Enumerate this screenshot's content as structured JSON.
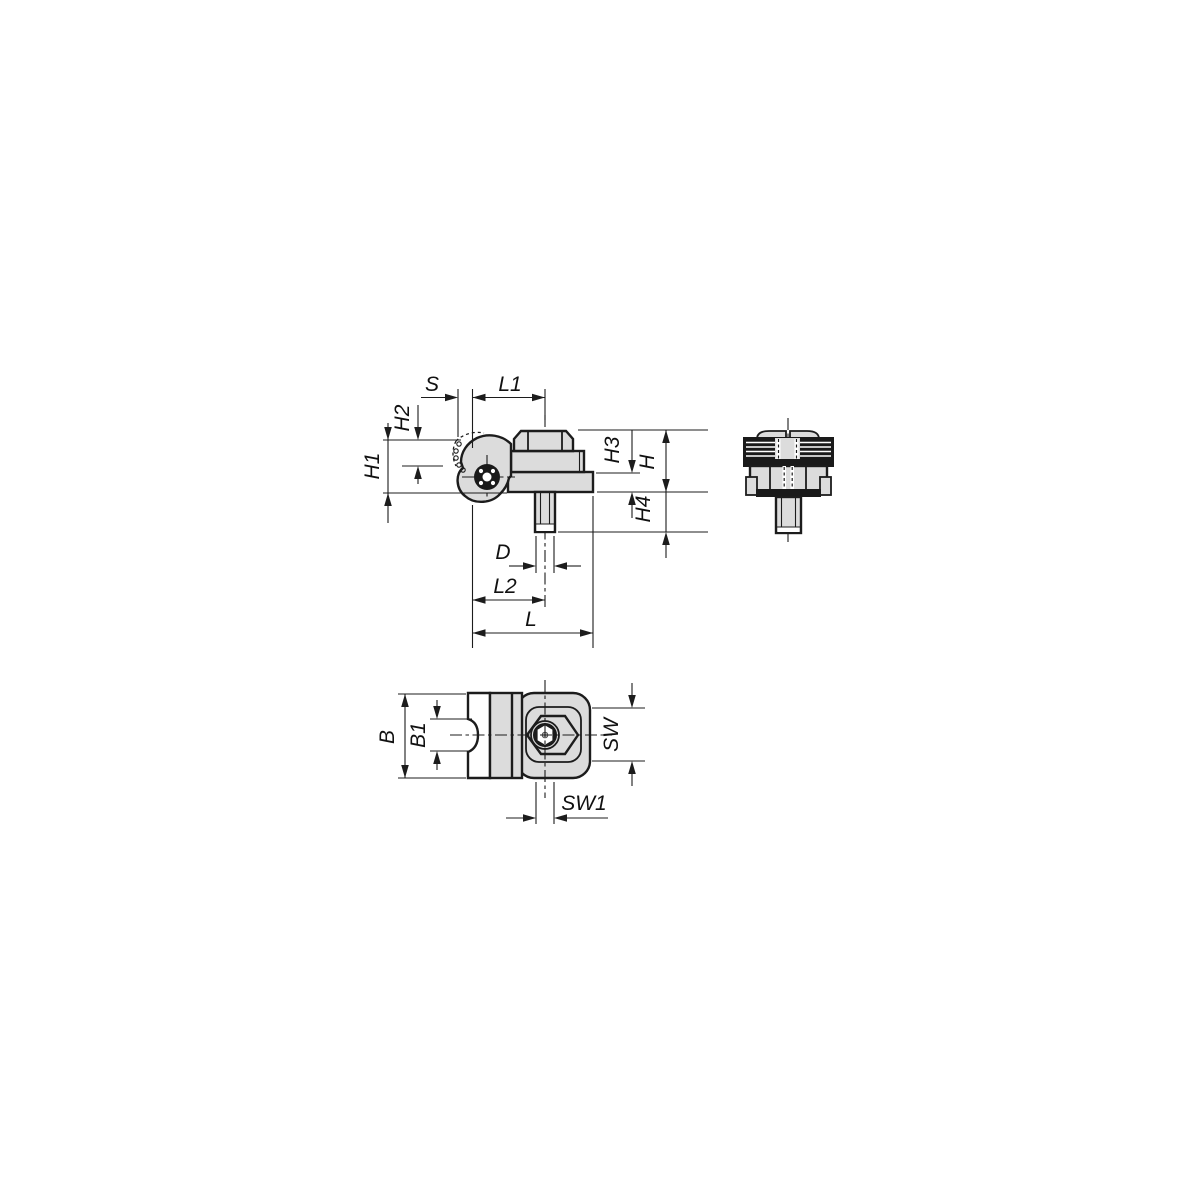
{
  "drawing": {
    "colors": {
      "background": "#ffffff",
      "line": "#1c1c1c",
      "part_fill": "#dcdcdc",
      "knurl_dark": "#1a1a1a"
    },
    "dimension_labels": {
      "s": "S",
      "l1": "L1",
      "h1": "H1",
      "h2": "H2",
      "h3": "H3",
      "h": "H",
      "h4": "H4",
      "d": "D",
      "l2": "L2",
      "l": "L",
      "b": "B",
      "b1": "B1",
      "sw": "SW",
      "sw1": "SW1"
    }
  }
}
